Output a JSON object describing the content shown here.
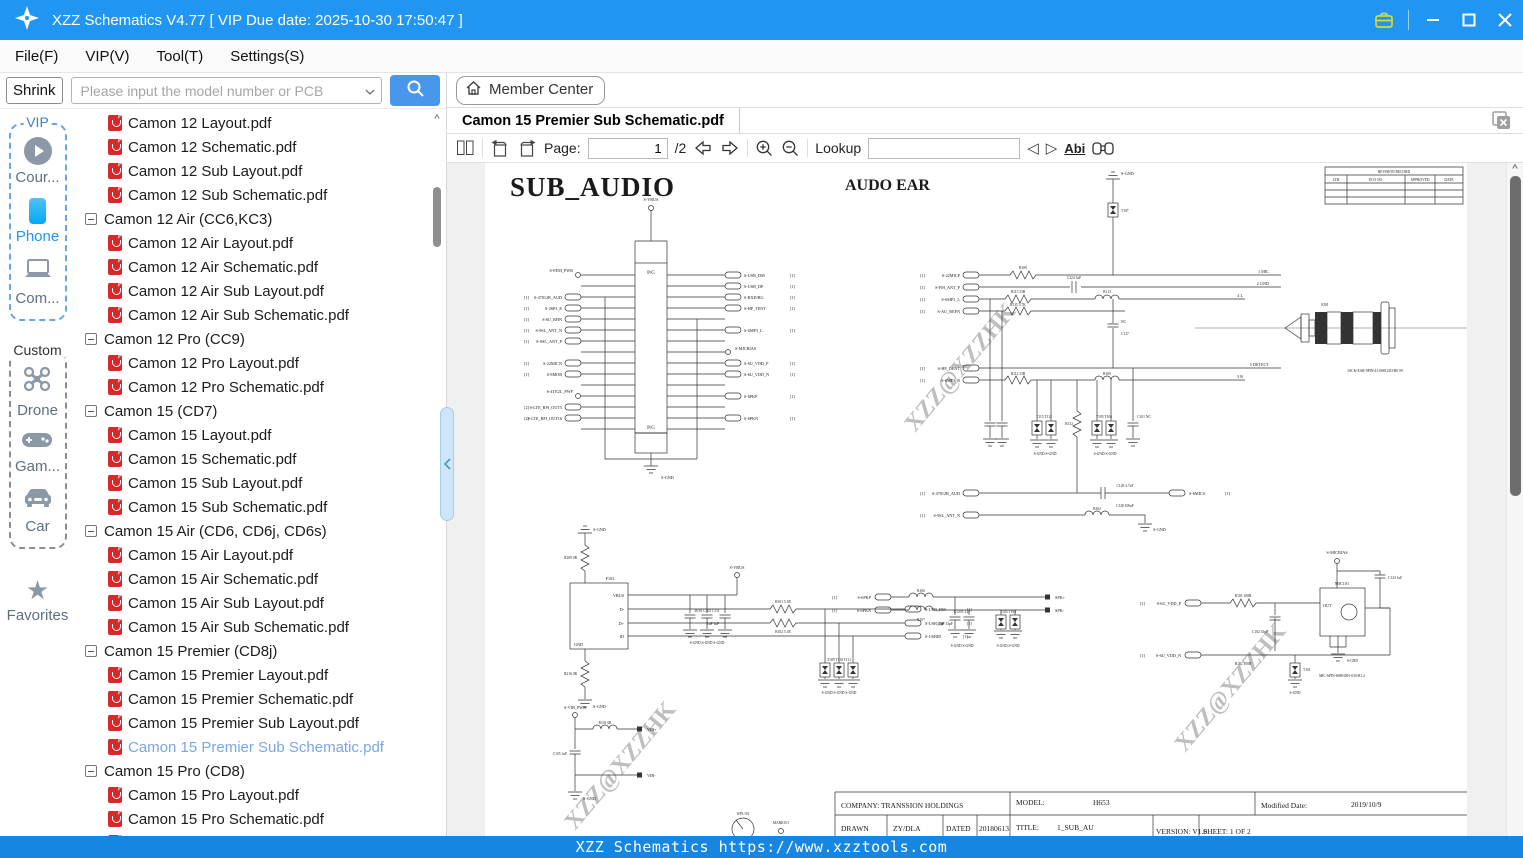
{
  "titlebar": {
    "title": "XZZ Schematics V4.77 [ VIP Due date: 2025-10-30 17:50:47 ]"
  },
  "menu": {
    "items": [
      "File(F)",
      "VIP(V)",
      "Tool(T)",
      "Settings(S)"
    ]
  },
  "search": {
    "shrink": "Shrink",
    "placeholder": "Please input the model number or PCB"
  },
  "member": {
    "label": "Member Center"
  },
  "tab": {
    "title": "Camon 15 Premier Sub Schematic.pdf"
  },
  "toolbar": {
    "page_label": "Page:",
    "page_value": "1",
    "page_total": "/2",
    "lookup_label": "Lookup",
    "abi": "Abi"
  },
  "sidebar": {
    "vip_title": "VIP",
    "custom_title": "Custom",
    "favorites": "Favorites",
    "vip_items": [
      {
        "label": "Cour..."
      },
      {
        "label": "Phone"
      },
      {
        "label": "Com..."
      }
    ],
    "custom_items": [
      {
        "label": "Drone"
      },
      {
        "label": "Gam..."
      },
      {
        "label": "Car"
      }
    ]
  },
  "tree": {
    "items": [
      {
        "type": "file",
        "label": "Camon 12 Layout.pdf"
      },
      {
        "type": "file",
        "label": "Camon 12 Schematic.pdf"
      },
      {
        "type": "file",
        "label": "Camon 12 Sub Layout.pdf"
      },
      {
        "type": "file",
        "label": "Camon 12 Sub Schematic.pdf"
      },
      {
        "type": "group",
        "label": "Camon 12 Air (CC6,KC3)"
      },
      {
        "type": "file",
        "label": "Camon 12 Air Layout.pdf"
      },
      {
        "type": "file",
        "label": "Camon 12 Air Schematic.pdf"
      },
      {
        "type": "file",
        "label": "Camon 12 Air Sub Layout.pdf"
      },
      {
        "type": "file",
        "label": "Camon 12 Air Sub Schematic.pdf"
      },
      {
        "type": "group",
        "label": "Camon 12 Pro (CC9)"
      },
      {
        "type": "file",
        "label": "Camon 12 Pro Layout.pdf"
      },
      {
        "type": "file",
        "label": "Camon 12 Pro Schematic.pdf"
      },
      {
        "type": "group",
        "label": "Camon 15 (CD7)"
      },
      {
        "type": "file",
        "label": "Camon 15 Layout.pdf"
      },
      {
        "type": "file",
        "label": "Camon 15 Schematic.pdf"
      },
      {
        "type": "file",
        "label": "Camon 15 Sub Layout.pdf"
      },
      {
        "type": "file",
        "label": "Camon 15 Sub Schematic.pdf"
      },
      {
        "type": "group",
        "label": "Camon 15 Air (CD6, CD6j, CD6s)"
      },
      {
        "type": "file",
        "label": "Camon 15 Air Layout.pdf"
      },
      {
        "type": "file",
        "label": "Camon 15 Air Schematic.pdf"
      },
      {
        "type": "file",
        "label": "Camon 15 Air Sub Layout.pdf"
      },
      {
        "type": "file",
        "label": "Camon 15 Air Sub Schematic.pdf"
      },
      {
        "type": "group",
        "label": "Camon 15 Premier (CD8j)"
      },
      {
        "type": "file",
        "label": "Camon 15 Premier Layout.pdf"
      },
      {
        "type": "file",
        "label": "Camon 15 Premier Schematic.pdf"
      },
      {
        "type": "file",
        "label": "Camon 15 Premier Sub Layout.pdf"
      },
      {
        "type": "file-sel",
        "label": "Camon 15 Premier Sub Schematic.pdf"
      },
      {
        "type": "group",
        "label": "Camon 15 Pro (CD8)"
      },
      {
        "type": "file",
        "label": "Camon 15 Pro Layout.pdf"
      },
      {
        "type": "file",
        "label": "Camon 15 Pro Schematic.pdf"
      },
      {
        "type": "file",
        "label": "Camon 15 Pro Sub Layout.pdf"
      }
    ]
  },
  "statusbar": {
    "text": "XZZ Schematics https://www.xzztools.com"
  },
  "schematic": {
    "title": "SUB_AUDIO",
    "section_title": "AUDO EAR",
    "watermark": "XZZ@XZZHK",
    "ref1": "[1]",
    "ref2": "[2]",
    "rev": {
      "title": "REVISION RECORD",
      "c0": "LTR",
      "c1": "ECO NO.",
      "c2": "APPROVED",
      "c3": "DATE"
    },
    "fpc": {
      "vbus": "S-VBUS",
      "gnd": "S-GND",
      "pg": "P/G",
      "left": [
        "S-FEM_PWR",
        "S-47812B_AUD",
        "S-26P3_E",
        "S-6U_RHN",
        "S-9SL_ANT_N",
        "S-9SL_ANT_P",
        "S-22MICN",
        "S-8MOB",
        "S-4TE2L_PWF",
        "S-LTE_RFI_OUT5",
        "S-LTE_RFI_OUT16"
      ],
      "right": [
        "S-USB_DM",
        "S-USB_DP",
        "S-RXD/RG",
        "S-HP_TENT",
        "S-6MP3_L",
        "S-MICBIAS",
        "S-6U_VDD_P",
        "S-6U_VDD_N",
        "S-6PKP",
        "S-6PKN"
      ]
    },
    "jack": {
      "in0": "S-22MICP",
      "in1": "S-FM_ANT_P",
      "in2": "S-6MP3_L",
      "in3": "S-AU_REFN",
      "in4": "S-HP_DENT",
      "in5": "S-6MP3_R",
      "p0": "1  MIC",
      "p1": "2  GND",
      "p2": "4  L",
      "p3": "5  DETECT",
      "p4": "3  R",
      "r108": "R108",
      "c124": "C124  1uF",
      "r113": "R113  33R",
      "r115": "R115  5.7K",
      "r112": "R112  33R",
      "b113": "B113",
      "r109": "R109",
      "t107": "T107",
      "gnd_top": "S-GND",
      "c127": "C127",
      "nc": "NC",
      "esd1": "T115  T112",
      "esd2": "T105  T106",
      "c101": "C101  NC",
      "r132": "R132",
      "gnds": "S-GND  S-GND",
      "c129": "C129  4.7uF",
      "c128": "C128  100nF",
      "mics": "S-6MICS",
      "aud": "S-47812B_AUD",
      "ant": "S-9SL_ANT_N",
      "b102": "B102",
      "gnd2": "S-GND",
      "ej": "EJ01",
      "pn": "JACK-EAR-9PIN-41-008123D-R0.99"
    },
    "usb": {
      "ref": "F102",
      "p1": "VBUS",
      "p2": "D-",
      "p3": "D+",
      "p4": "ID",
      "p5": "GND",
      "vbus": "S-VBUS",
      "r209": "R209  0R",
      "r216": "R216  0R",
      "gnd": "S-GND",
      "caps": "D101   C103   C111",
      "vals": "1uF   1uF",
      "r101": "R101  5.1R",
      "r102": "R102  5.1R",
      "esd": "T109  T110  T111",
      "gnds": "S-GND S-GND S-GND",
      "dm": "S-USB_DM",
      "dp": "S-USB_DP",
      "id": "S-USBID"
    },
    "spk": {
      "p": "S-6PKP",
      "n": "S-6PKN",
      "r106": "R106",
      "r107": "R107",
      "c": "C120  C121",
      "val": "33pF  33pF",
      "esd": "T103  T104",
      "gnds": "S-GND  S-GND",
      "pad1": "SPK+",
      "pad2": "SPK-"
    },
    "mic": {
      "p": "S-6U_VDD_P",
      "n": "S-6U_VDD_N",
      "r181": "R181  100R",
      "r182": "R182  100R",
      "c102": "C102  33pF",
      "t101": "T101",
      "ref": "MIC101",
      "out": "OUT",
      "bias": "S-MICBIAS",
      "c123": "C123  1uF",
      "pn": "MIC-6PIN-60803091-030-R1.2",
      "gnd": "S-GND"
    },
    "vib": {
      "pwr": "S-VIB_PWR",
      "r": "R103  0R",
      "c": "C105  1uF",
      "p1": "VIB+",
      "p2": "VIB-",
      "gnd": "S-GND",
      "wpl": "WPL101",
      "mark": "MARK101"
    },
    "tb": {
      "company": "COMPANY:  TRANSSION HOLDINGS",
      "model_label": "MODEL:",
      "model": "H653",
      "mod_label": "Modified Date:",
      "mod": "2019/10/9",
      "drawn": "DRAWN",
      "drawn_v": "ZY/DLA",
      "dated": "DATED",
      "dated_v": "20180613",
      "title_label": "TITLE:",
      "title": "1_SUB_AU",
      "version": "VERSION:  V1.0",
      "sheet": "SHEET:  1  OF  2"
    }
  }
}
